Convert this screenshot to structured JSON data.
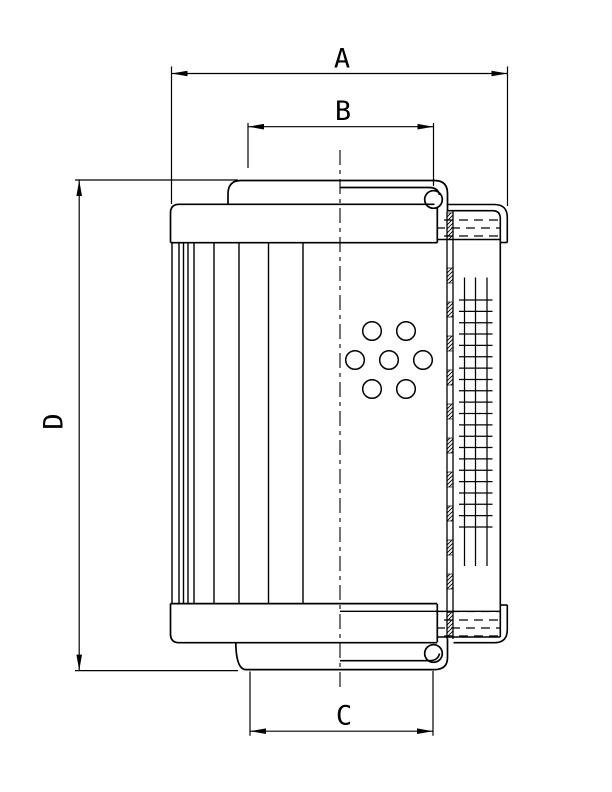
{
  "dimensions": {
    "a_label": "A",
    "b_label": "B",
    "c_label": "C",
    "d_label": "D"
  },
  "colors": {
    "line": "#000000",
    "background": "#ffffff"
  }
}
